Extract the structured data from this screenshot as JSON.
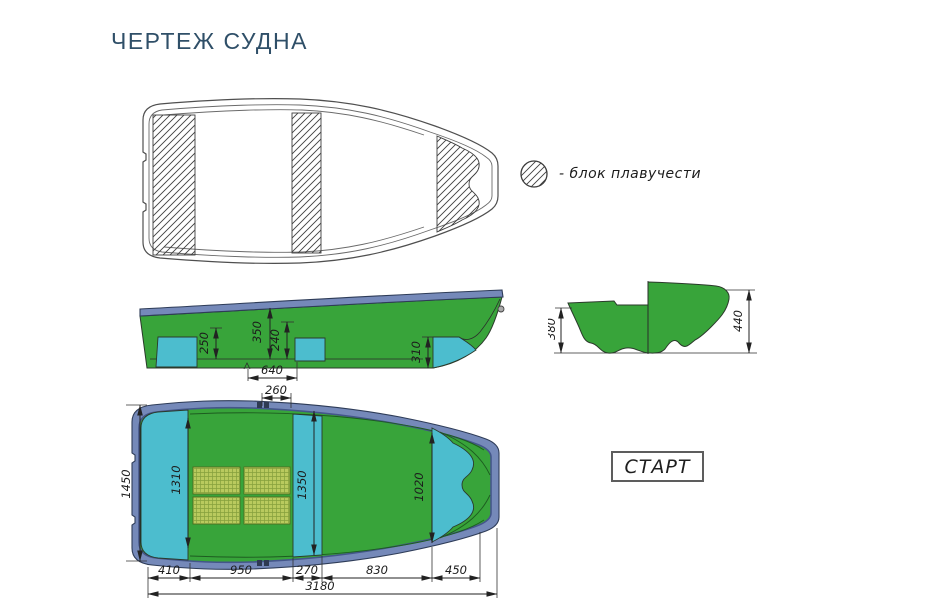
{
  "title": "ЧЕРТЕЖ СУДНА",
  "legend": {
    "text": "- блок плавучести"
  },
  "start_label": "СТАРТ",
  "dims": {
    "side": {
      "v250": "250",
      "v350": "350",
      "v240": "240",
      "v640": "640",
      "v310": "310"
    },
    "section": {
      "v380": "380",
      "v440": "440"
    },
    "plan": {
      "v260": "260",
      "v1450": "1450",
      "v1310": "1310",
      "v1350": "1350",
      "v1020": "1020",
      "v410": "410",
      "v950": "950",
      "v270": "270",
      "v830": "830",
      "v450": "450",
      "v3180": "3180"
    }
  },
  "colors": {
    "hull-green": "#38a43a",
    "block-cyan": "#4cbdce",
    "rim-blue": "#7589b9",
    "rim-edge": "#44568a",
    "grate-yellow": "#b9ca5e",
    "grate-line": "#85a03c",
    "line-dark": "#2b3a2b",
    "dim-color": "#222222",
    "title-color": "#2f4f68",
    "text-color": "#1c1c1c"
  }
}
